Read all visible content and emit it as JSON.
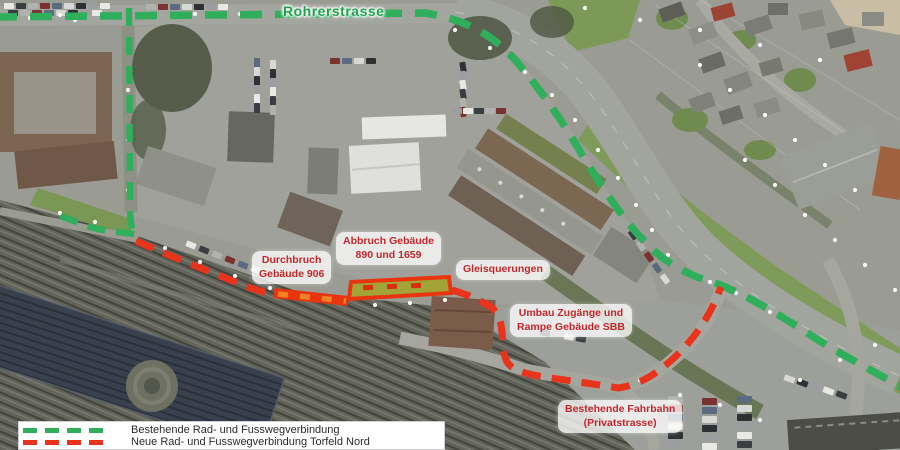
{
  "map": {
    "road_label": "Rohrerstrasse",
    "callouts": [
      {
        "id": "durchbruch",
        "line1": "Durchbruch",
        "line2": "Gebäude 906"
      },
      {
        "id": "abbruch",
        "line1": "Abbruch Gebäude",
        "line2": "890 und 1659"
      },
      {
        "id": "gleisquerungen",
        "line1": "Gleisquerungen"
      },
      {
        "id": "umbau",
        "line1": "Umbau Zugänge und",
        "line2": "Rampe Gebäude SBB"
      },
      {
        "id": "fahrbahn",
        "line1": "Bestehende Fahrbahn",
        "line2": "(Privatstrasse)"
      }
    ],
    "legend": {
      "items": [
        {
          "label": "Bestehende Rad- und Fusswegverbindung",
          "color": "#2fae5b"
        },
        {
          "label": "Neue Rad- und Fusswegverbindung Torfeld Nord",
          "color": "#e8341c"
        }
      ]
    },
    "colors": {
      "existing_route_green": "#2fae5b",
      "new_route_red": "#e8341c",
      "construction_orange": "#f08125",
      "building_highlight_olive": "#a3a437",
      "callout_text_red": "#c4272b",
      "road_label_green": "#1fa24d"
    }
  }
}
